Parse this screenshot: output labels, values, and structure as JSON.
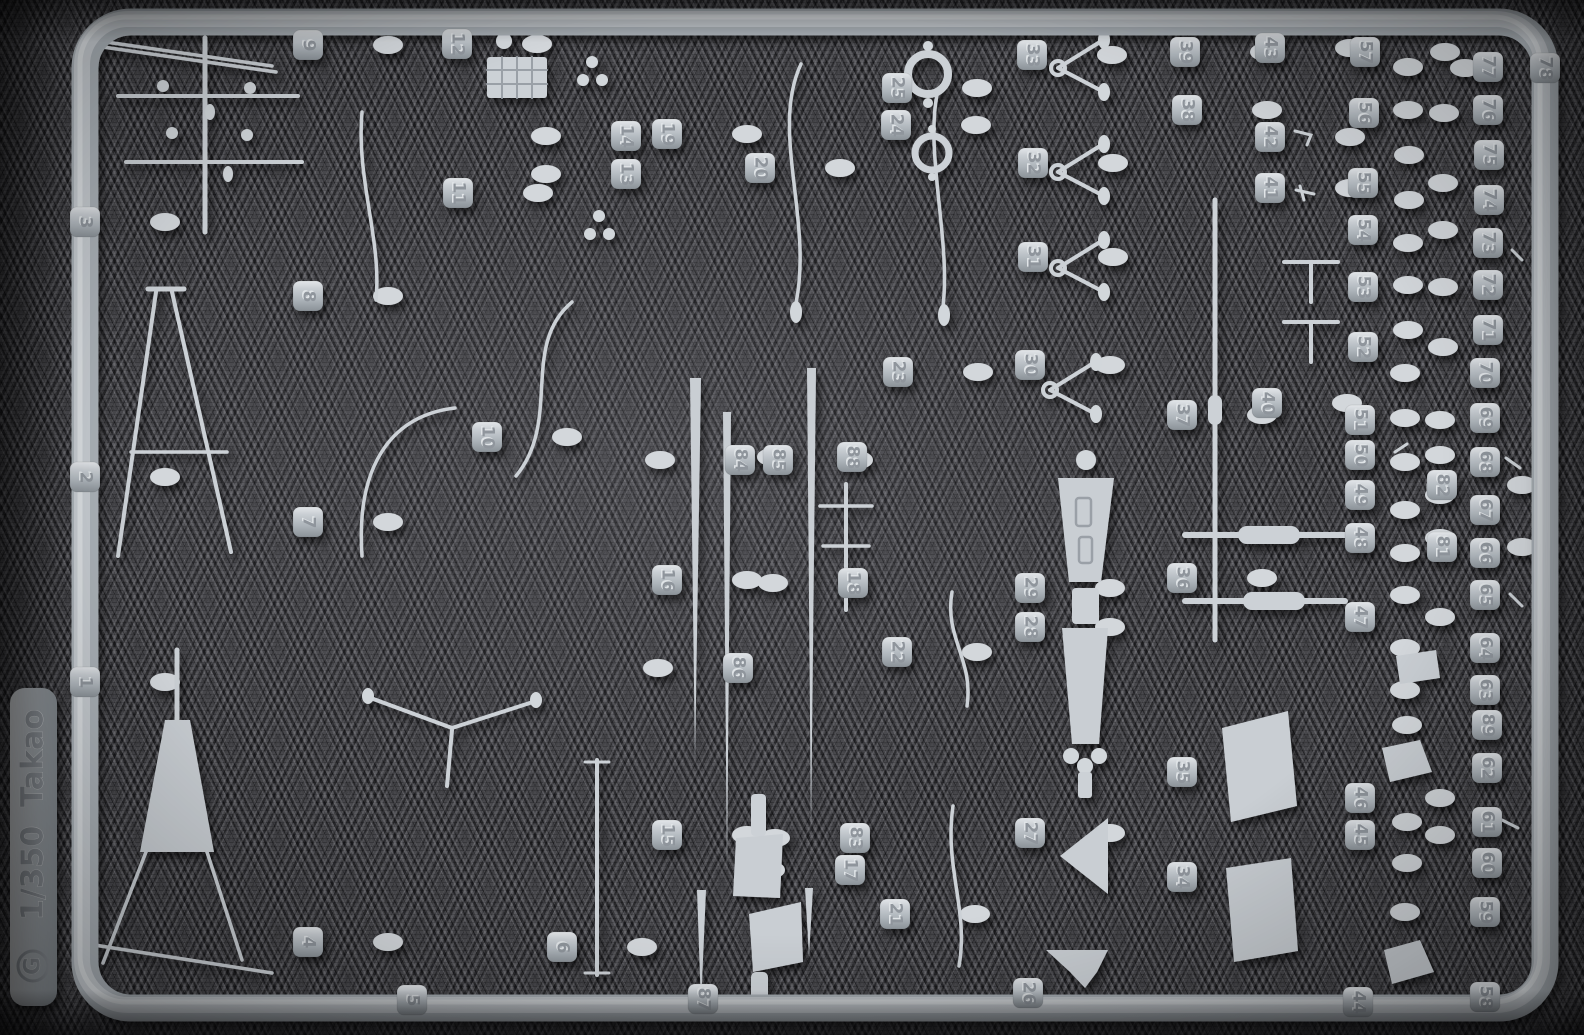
{
  "photo": {
    "subject": "Injection-molded light-grey plastic model sprue photographed on dark knit fabric",
    "colors": {
      "plastic": "#c2c8cd",
      "plastic_highlight": "#e3e6e9",
      "plastic_shadow": "#8b9298",
      "fabric": "#47474b"
    }
  },
  "sprue_tag": {
    "gate_letter": "G",
    "scale": "1/350",
    "kit_name": "Takao"
  },
  "part_tabs": [
    [
      3,
      85,
      222
    ],
    [
      2,
      85,
      477
    ],
    [
      1,
      85,
      682
    ],
    [
      9,
      308,
      45
    ],
    [
      8,
      308,
      296
    ],
    [
      7,
      308,
      522
    ],
    [
      4,
      308,
      942
    ],
    [
      12,
      457,
      44
    ],
    [
      11,
      458,
      193
    ],
    [
      10,
      487,
      437
    ],
    [
      5,
      412,
      1000
    ],
    [
      6,
      562,
      947
    ],
    [
      14,
      626,
      136
    ],
    [
      13,
      626,
      174
    ],
    [
      19,
      667,
      134
    ],
    [
      16,
      667,
      580
    ],
    [
      15,
      667,
      835
    ],
    [
      20,
      760,
      168
    ],
    [
      84,
      740,
      460
    ],
    [
      85,
      778,
      460
    ],
    [
      86,
      738,
      668
    ],
    [
      87,
      703,
      999
    ],
    [
      25,
      897,
      88
    ],
    [
      24,
      896,
      125
    ],
    [
      23,
      898,
      372
    ],
    [
      88,
      852,
      457
    ],
    [
      18,
      853,
      583
    ],
    [
      22,
      897,
      652
    ],
    [
      83,
      855,
      838
    ],
    [
      17,
      850,
      870
    ],
    [
      21,
      895,
      914
    ],
    [
      33,
      1032,
      55
    ],
    [
      32,
      1033,
      163
    ],
    [
      31,
      1033,
      257
    ],
    [
      30,
      1030,
      365
    ],
    [
      29,
      1030,
      588
    ],
    [
      28,
      1030,
      627
    ],
    [
      27,
      1030,
      833
    ],
    [
      26,
      1028,
      993
    ],
    [
      39,
      1185,
      52
    ],
    [
      38,
      1187,
      110
    ],
    [
      37,
      1182,
      415
    ],
    [
      36,
      1182,
      578
    ],
    [
      35,
      1182,
      772
    ],
    [
      34,
      1182,
      877
    ],
    [
      43,
      1270,
      48
    ],
    [
      42,
      1270,
      137
    ],
    [
      41,
      1270,
      188
    ],
    [
      40,
      1267,
      403
    ],
    [
      57,
      1365,
      52
    ],
    [
      56,
      1364,
      113
    ],
    [
      55,
      1363,
      183
    ],
    [
      54,
      1363,
      230
    ],
    [
      53,
      1363,
      287
    ],
    [
      52,
      1363,
      347
    ],
    [
      51,
      1360,
      420
    ],
    [
      50,
      1360,
      455
    ],
    [
      49,
      1360,
      495
    ],
    [
      48,
      1360,
      538
    ],
    [
      47,
      1360,
      617
    ],
    [
      46,
      1360,
      798
    ],
    [
      45,
      1360,
      835
    ],
    [
      44,
      1358,
      1002
    ],
    [
      82,
      1442,
      485
    ],
    [
      81,
      1442,
      547
    ],
    [
      77,
      1488,
      67
    ],
    [
      76,
      1488,
      110
    ],
    [
      75,
      1489,
      155
    ],
    [
      74,
      1489,
      200
    ],
    [
      73,
      1488,
      243
    ],
    [
      72,
      1488,
      285
    ],
    [
      71,
      1488,
      330
    ],
    [
      70,
      1485,
      373
    ],
    [
      69,
      1485,
      418
    ],
    [
      68,
      1485,
      462
    ],
    [
      67,
      1485,
      510
    ],
    [
      66,
      1485,
      553
    ],
    [
      65,
      1485,
      595
    ],
    [
      64,
      1485,
      648
    ],
    [
      63,
      1485,
      690
    ],
    [
      89,
      1487,
      725
    ],
    [
      62,
      1487,
      768
    ],
    [
      61,
      1487,
      822
    ],
    [
      60,
      1487,
      863
    ],
    [
      59,
      1485,
      912
    ],
    [
      58,
      1485,
      997
    ],
    [
      78,
      1545,
      68
    ]
  ]
}
